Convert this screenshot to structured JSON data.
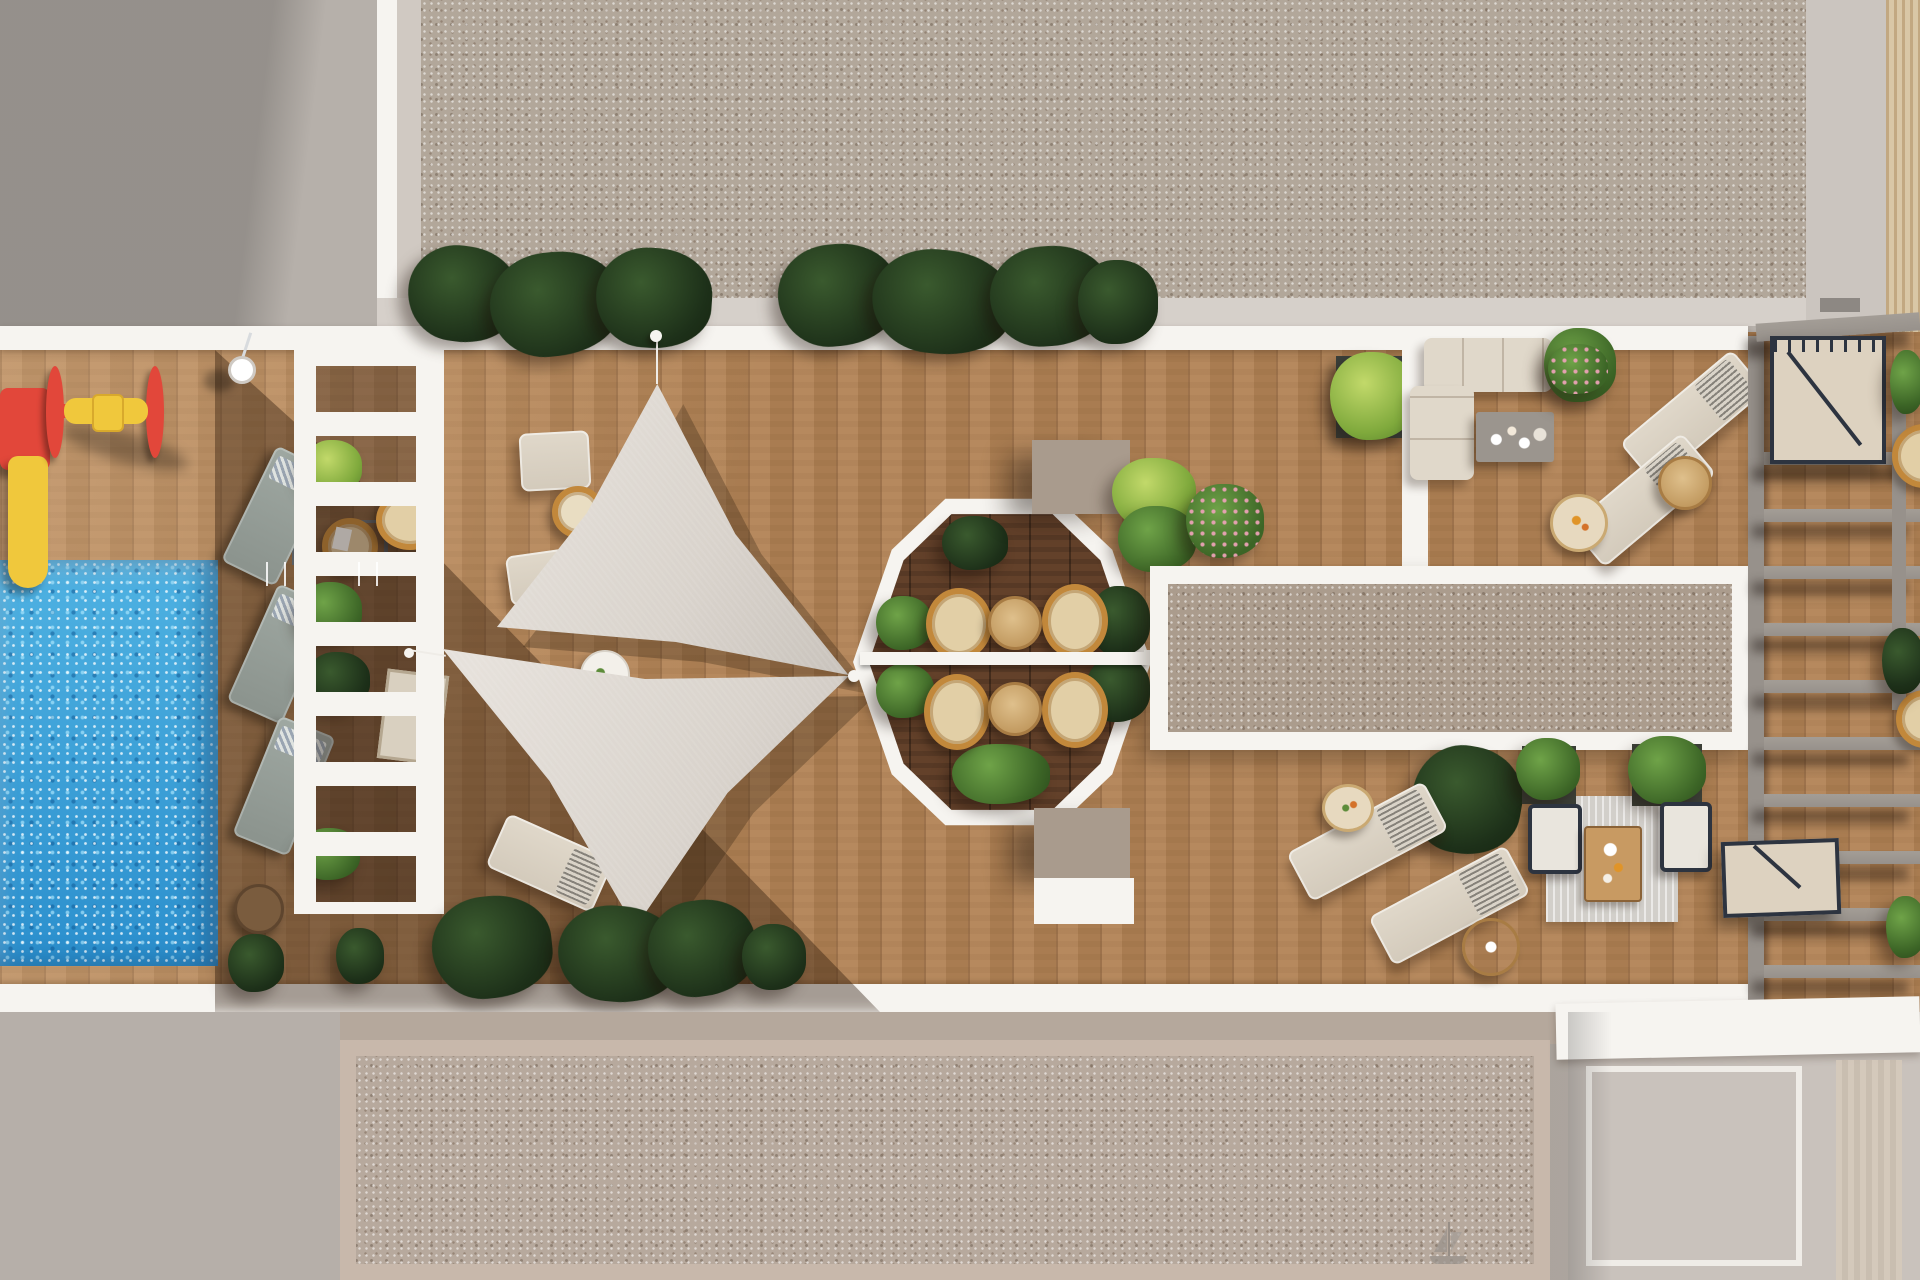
{
  "scene": {
    "type": "architectural-render",
    "view": "top-down-aerial",
    "title": "Rooftop amenity terrace - 3D plan render",
    "labels": {
      "plaza": "Surrounding plaza paving",
      "north_roof": "Gravel roof terrace (top block)",
      "south_roof": "Gravel courtyard (bottom block)",
      "sun_deck": "Timber sun deck",
      "pool": "Swimming pool",
      "pool_ladder": "Pool ladder",
      "playground": "Kids playground with slide and spinner",
      "pool_loungers": "Poolside loungers",
      "trellis": "White trellis walkway",
      "shade_sails": "Triangular shade sails",
      "sail_deck_chairs": "Deck chairs under the sails",
      "dining_octagon": "Octagonal dining pod",
      "dining_set": "Rattan chairs and round tables",
      "gravel_island": "Gravel roof island",
      "corner_sofa": "Corner lounge sofa",
      "coffee_table": "Coffee table",
      "sun_loungers": "Cream sun loungers",
      "outdoor_lounge": "Outdoor lounge set on rug",
      "pergola": "Slatted pergola deck",
      "stairs": "Stair access hatch",
      "planting": "Terrace planting",
      "boat_sketch": "Sailboat motif etched in gravel",
      "lamp": "Deck light"
    },
    "inventory": {
      "shade_sails": 2,
      "pools": 1,
      "gray_pool_loungers": 3,
      "white_deck_chairs": 3,
      "cream_sun_loungers": 4,
      "rattan_dining_chairs": 4,
      "round_dining_tables": 2,
      "corner_sofas": 1,
      "lounge_armchairs": 2,
      "stair_hatches": 2,
      "playground_pieces": 2
    }
  },
  "palette": {
    "plaza_gray": "#b6b0aa",
    "plaza_shadow": "#98948f",
    "walkway_white": "#f6f4f0",
    "gravel_beige": "#b2a79a",
    "gravel_border": "#c8b8ab",
    "deck_wood": "#b28355",
    "deck_wood_dark": "#63412a",
    "pool_blue": "#2f9ed6",
    "sail_fabric": "#d9d3cc",
    "playground_red": "#e2473a",
    "playground_yellow": "#f0c83c",
    "plant_dark": "#1d3019",
    "plant_green": "#3c6526",
    "plant_lime": "#7fa93c",
    "rattan_tan": "#c2883b",
    "cushion_cream": "#e0d8ca",
    "lounger_gray": "#8b938d",
    "pergola_beam": "#97918b",
    "stair_beige": "#ddd2c0",
    "frame_navy": "#2d3440",
    "table_wood": "#c89a62",
    "taupe_block": "#a99b8d",
    "rug_gray": "#d2cfca"
  }
}
